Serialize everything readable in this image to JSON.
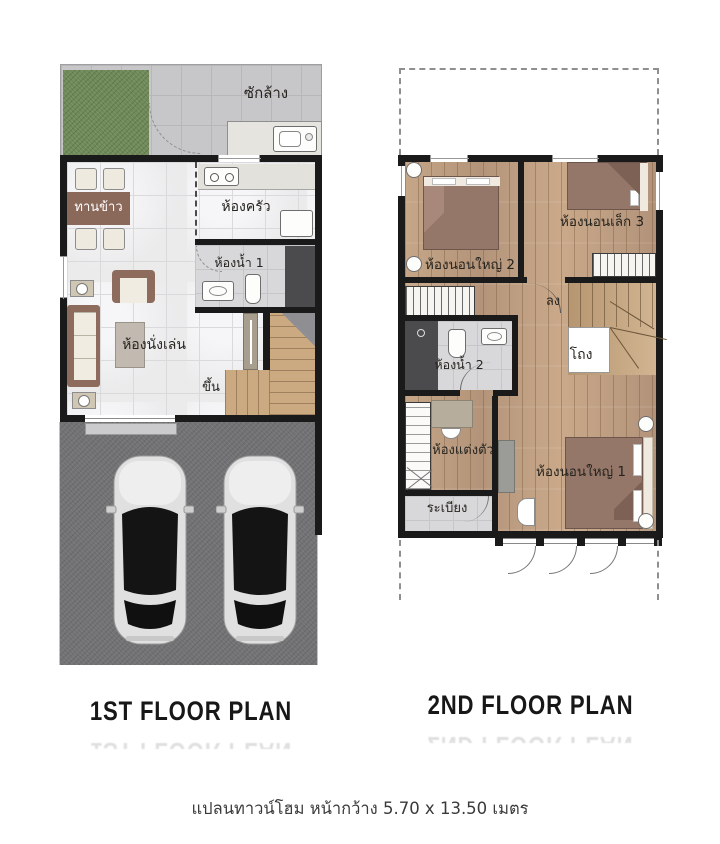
{
  "title": "Townhome floor plans",
  "colors": {
    "wall": "#1a1a1a",
    "marble": "#ebebec",
    "tilegray": "#c7c7ca",
    "garden": "#6f8a58",
    "wood": "#c0a183",
    "garage": "#737376",
    "furnbrown": "#8d6c5e",
    "bedbrown": "#957769",
    "cream": "#f0ece1",
    "tilelight": "#d8d8da",
    "shower": "#4b4b4d",
    "ink": "#1f1f1f"
  },
  "plan1": {
    "caption": "1ST FLOOR PLAN",
    "rooms": {
      "laundry": "ซักล้าง",
      "dining": "ทานข้าว",
      "kitchen": "ห้องครัว",
      "bathroom1": "ห้องน้ำ 1",
      "living": "ห้องนั่งเล่น",
      "stairs_up": "ขึ้น"
    }
  },
  "plan2": {
    "caption": "2ND FLOOR PLAN",
    "rooms": {
      "bedroom2": "ห้องนอนใหญ่ 2",
      "bedroom3": "ห้องนอนเล็ก 3",
      "stairs_down": "ลง",
      "hall": "โถง",
      "bathroom2": "ห้องน้ำ 2",
      "dressing": "ห้องแต่งตัว",
      "bedroom1": "ห้องนอนใหญ่ 1",
      "balcony": "ระเบียง"
    }
  },
  "footer": {
    "dimension_text": "แปลนทาวน์โฮม หน้ากว้าง 5.70 x 13.50 เมตร"
  }
}
